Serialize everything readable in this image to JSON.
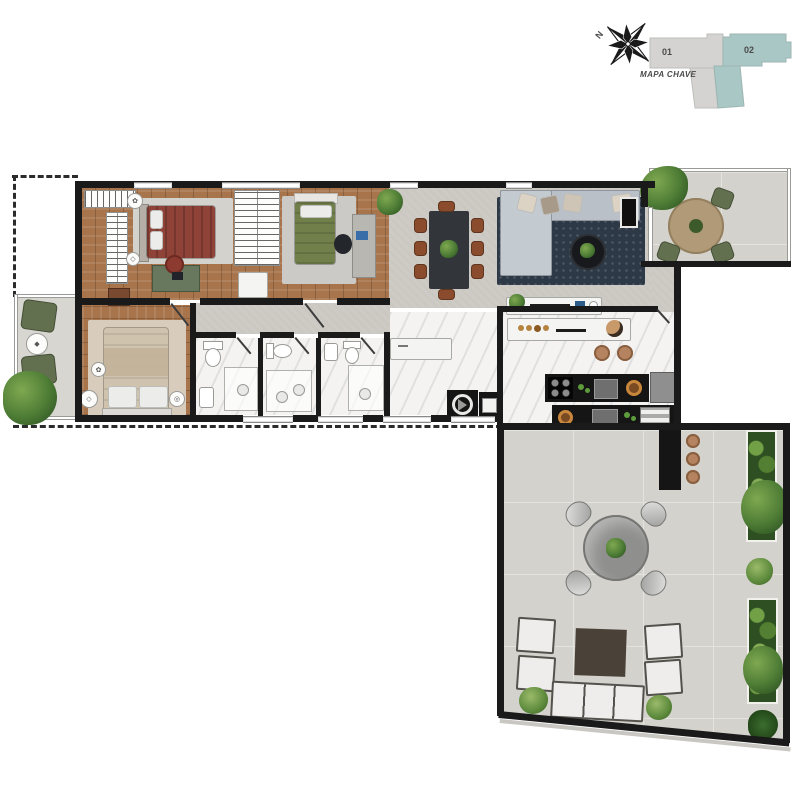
{
  "canvas": {
    "width": 800,
    "height": 800,
    "background": "#ffffff"
  },
  "key_map": {
    "title": "MAPA CHAVE",
    "compass_label": "N",
    "units": [
      {
        "label": "01",
        "color": "#d4d3d1"
      },
      {
        "label": "02",
        "color": "#a9c8c5"
      }
    ]
  },
  "palette": {
    "wall": "#1a1a1a",
    "wood": "#a8744c",
    "floorgray": "#cbc8c2",
    "tile": "#d4d2cc",
    "marble": "#f4f3f1",
    "bedmaroon": "#8f4237",
    "bedgreen": "#71804a",
    "bedbeige": "#cfc3ae",
    "sofagray": "#b9c0c7",
    "rugnavy": "#2e3947",
    "tabledark": "#32363b",
    "chairbrown": "#8a4c2c",
    "olive": "#62704f",
    "counterblack": "#151515",
    "stonetable": "#8f8f8d",
    "woodtable": "#b09a78",
    "stool": "#b5835f",
    "coffeebrown": "#4a4239"
  },
  "plan": {
    "boundary": "dashed-property-line",
    "rooms": [
      {
        "name": "suite-1-closet-bedroom",
        "floor": "wood",
        "furniture": [
          "wardrobe-racks",
          "double-bed-maroon",
          "desk",
          "office-chair",
          "nightstand-decor"
        ]
      },
      {
        "name": "bedroom-2",
        "floor": "wood",
        "furniture": [
          "wardrobe-rack",
          "single-bed-green",
          "study-desk",
          "office-chair",
          "pouf",
          "rug",
          "plant"
        ]
      },
      {
        "name": "suite-2-bedroom",
        "floor": "wood",
        "furniture": [
          "double-bed-beige",
          "nightstand-decor",
          "rug"
        ]
      },
      {
        "name": "bathroom-1",
        "floor": "marble",
        "furniture": [
          "toilet",
          "sink",
          "shower"
        ]
      },
      {
        "name": "bathroom-2",
        "floor": "marble",
        "furniture": [
          "toilet",
          "shower",
          "sink"
        ]
      },
      {
        "name": "bathroom-3",
        "floor": "marble",
        "furniture": [
          "toilet",
          "sink",
          "shower"
        ]
      },
      {
        "name": "laundry",
        "floor": "marble",
        "furniture": [
          "counter",
          "washing-machine",
          "tank-sink"
        ]
      },
      {
        "name": "kitchen",
        "floor": "marble",
        "furniture": [
          "breakfast-bar",
          "stools",
          "cooktop",
          "sink",
          "fridge",
          "oven",
          "counters"
        ]
      },
      {
        "name": "dining-area",
        "floor": "gray-cement",
        "furniture": [
          "dining-table",
          "eight-chairs",
          "plant-centerpiece"
        ]
      },
      {
        "name": "living-room",
        "floor": "gray-cement",
        "furniture": [
          "sectional-sofa",
          "navy-rug",
          "coffee-table",
          "tv",
          "sideboard"
        ]
      },
      {
        "name": "balcony-left",
        "floor": "gray",
        "furniture": [
          "armchair",
          "armchair",
          "side-table",
          "plant"
        ]
      },
      {
        "name": "terrace-north",
        "floor": "tile",
        "furniture": [
          "round-wood-table",
          "four-chairs",
          "plant"
        ]
      },
      {
        "name": "terrace-main",
        "floor": "tile",
        "furniture": [
          "bar-counter",
          "three-stools",
          "stone-round-table",
          "four-curved-chairs",
          "outdoor-sofa",
          "four-armchairs",
          "coffee-table",
          "planters",
          "plants"
        ]
      }
    ]
  }
}
